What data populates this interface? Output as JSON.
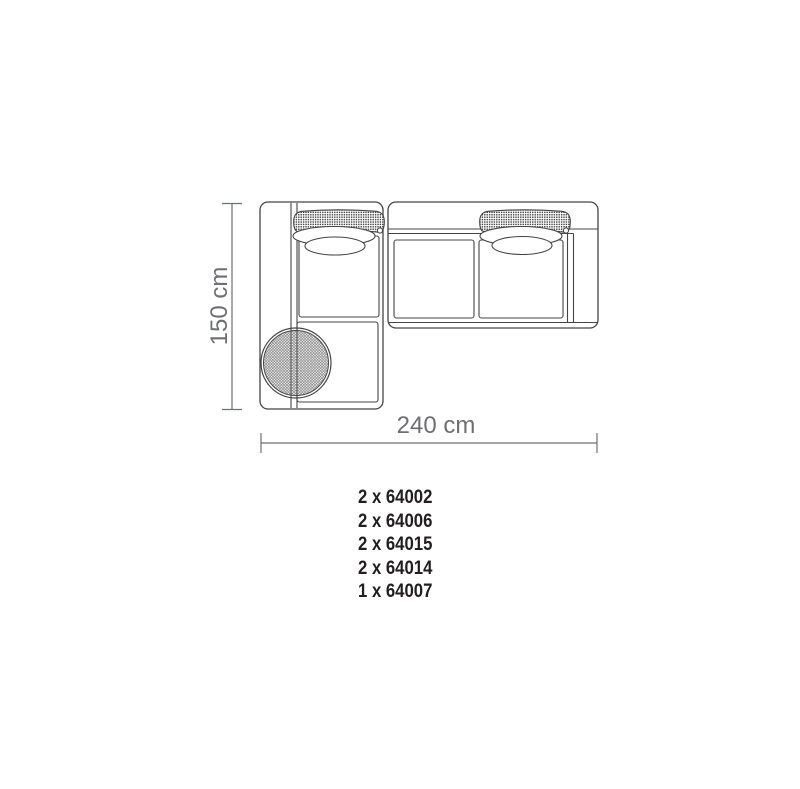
{
  "diagram": {
    "dimensions": {
      "height": "150 cm",
      "width": "240 cm"
    }
  },
  "parts_list": {
    "items": [
      "2 x 64002",
      "2 x 64006",
      "2 x 64015",
      "2 x 64014",
      "1 x 64007"
    ]
  },
  "colors": {
    "background": "#ffffff",
    "outline": "#444444",
    "dimension_gray": "#6e6f72",
    "parts_text": "#221e1f"
  }
}
